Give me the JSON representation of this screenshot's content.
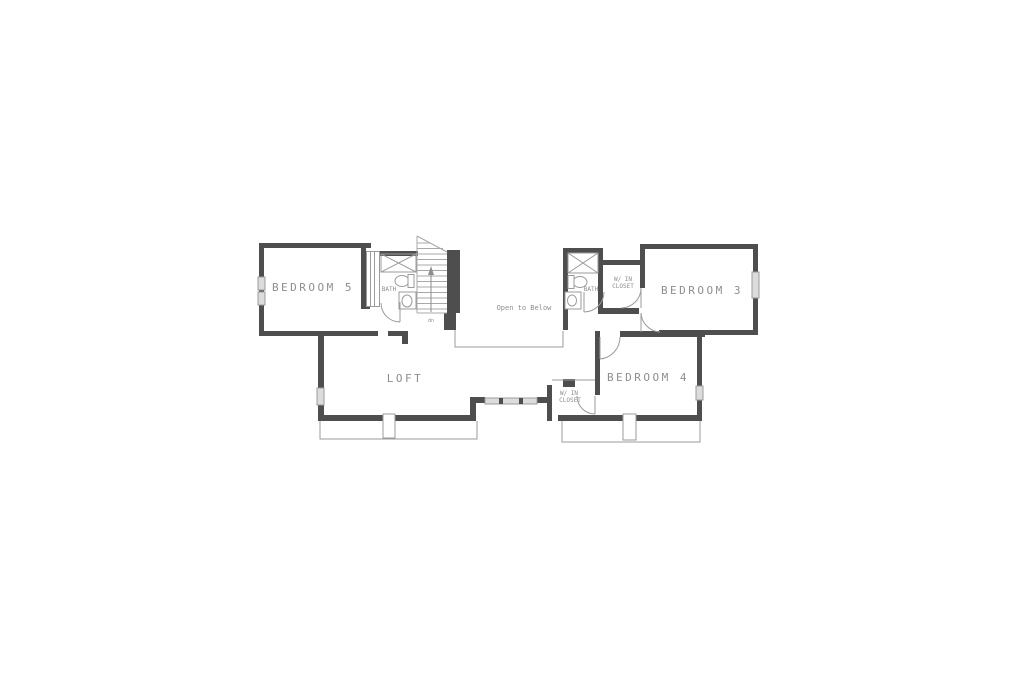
{
  "page": {
    "background": "#ffffff"
  },
  "plan": {
    "colors": {
      "wall": "#4e4e4e",
      "thin_line": "#9b9b9b",
      "window_fill": "#dcdcdc",
      "label_text": "#8e8e8e"
    },
    "rooms": {
      "bedroom5": "BEDROOM 5",
      "bath_left": "BATH",
      "bath_right": "BATH",
      "closet3_line1": "W/ IN",
      "closet3_line2": "CLOSET",
      "bedroom3": "BEDROOM 3",
      "bedroom4": "BEDROOM 4",
      "closet4_line1": "W/ IN",
      "closet4_line2": "CLOSET",
      "loft": "LOFT"
    },
    "annotations": {
      "open_to_below": "Open to Below",
      "stair_direction": "dn"
    }
  }
}
